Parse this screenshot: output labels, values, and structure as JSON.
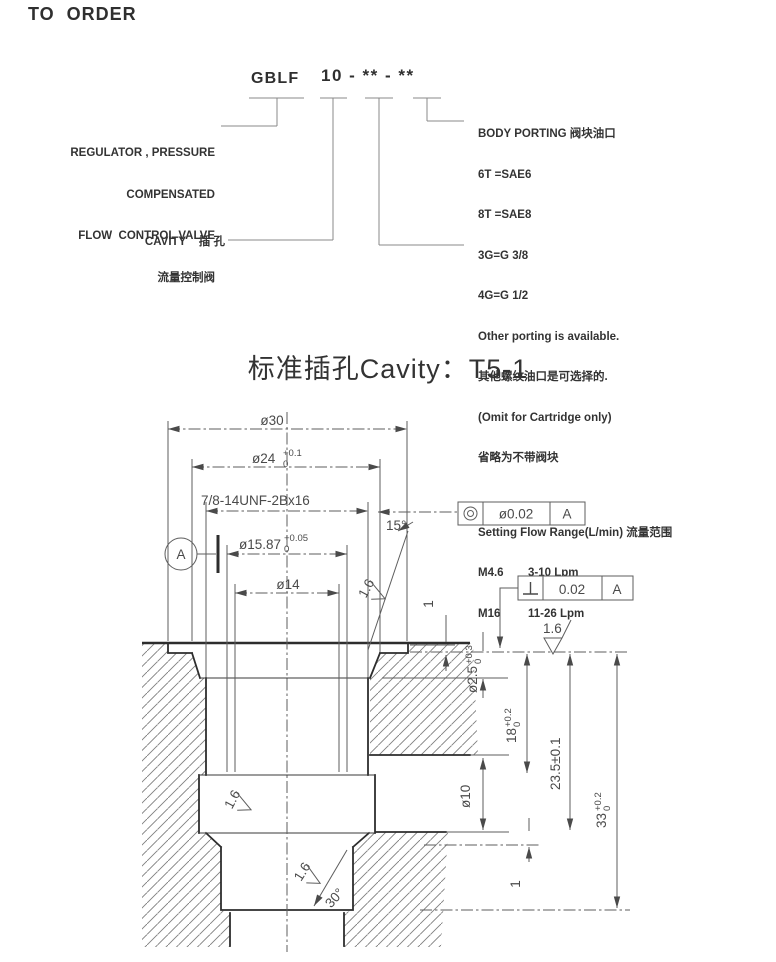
{
  "page_title": "TO ORDER",
  "order_code": {
    "prefix": "GBLF",
    "code": "10 - ** - **",
    "left_labels": {
      "regulator_lines": [
        "REGULATOR , PRESSURE",
        "COMPENSATED",
        "FLOW  CONTROL VALVE",
        "流量控制阀"
      ],
      "cavity": "CAVITY    插 孔"
    },
    "body_porting": {
      "header": "BODY PORTING 阀块油口",
      "options": [
        "6T =SAE6",
        "8T =SAE8",
        "3G=G 3/8",
        "4G=G 1/2"
      ],
      "notes": [
        "Other porting is available.",
        "其他螺纹油口是可选择的.",
        "(Omit for Cartridge only)",
        "省略为不带阀块"
      ]
    },
    "flow_range": {
      "header": "Setting Flow Range(L/min) 流量范围",
      "rows": [
        {
          "code": "M4.6",
          "range": "3-10 Lpm"
        },
        {
          "code": "M16",
          "range": "11-26 Lpm"
        }
      ]
    }
  },
  "cavity": {
    "title": "标准插孔Cavity：T5-1",
    "dims": {
      "d30": "ø30",
      "d24": "ø24",
      "d24_up": "+0.1",
      "d24_dn": "0",
      "thread": "7/8-14UNF-2Bx16",
      "d1587": "ø15.87",
      "d1587_up": "+0.05",
      "d1587_dn": "0",
      "d14": "ø14",
      "a15": "15°",
      "rough": "1.6",
      "depth1": "1",
      "d25": "ø2.5",
      "d25_up": "+0.3",
      "d25_dn": "0",
      "d18": "18",
      "d18_up": "+0.2",
      "d18_dn": "0",
      "d235": "23.5±0.1",
      "d33": "33",
      "d33_up": "+0.2",
      "d33_dn": "0",
      "d10": "ø10",
      "a30": "30°",
      "step1": "1",
      "datum": "A"
    },
    "tolerance_frames": {
      "concentricity": {
        "value": "ø0.02",
        "ref": "A"
      },
      "perpendicularity": {
        "value": "0.02",
        "ref": "A"
      }
    }
  }
}
